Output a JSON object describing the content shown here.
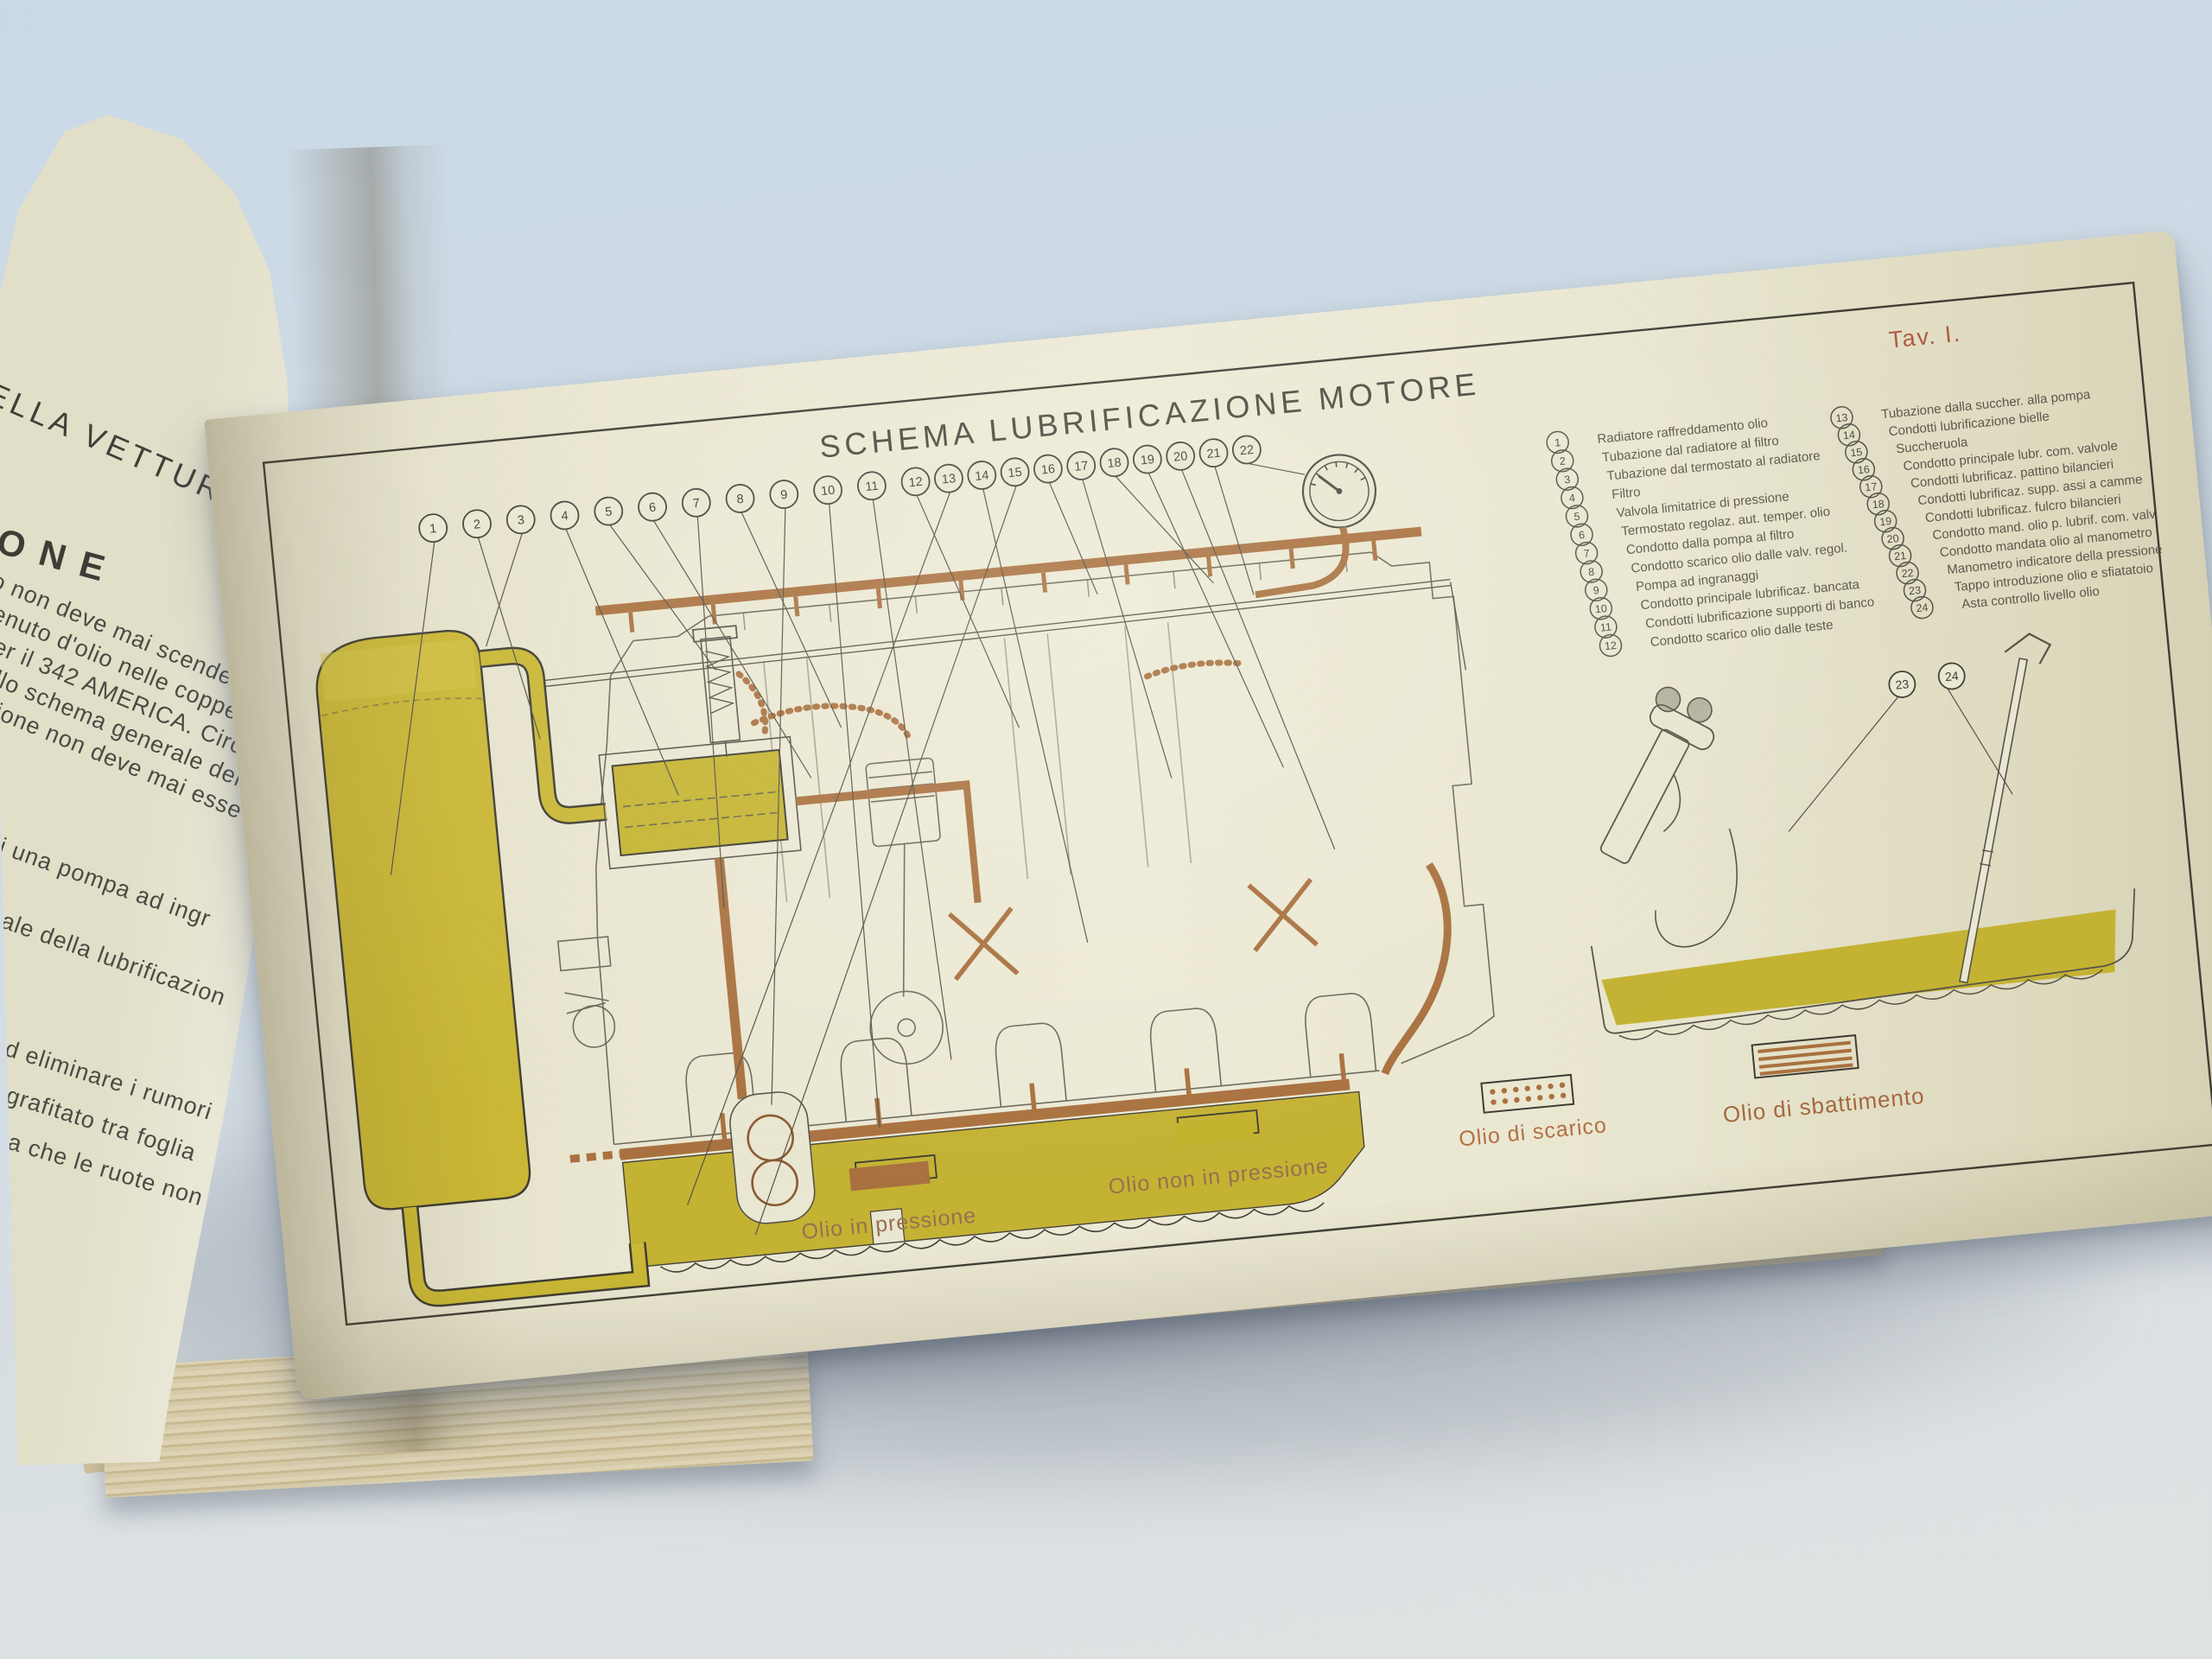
{
  "scene": {
    "description_background": "#cfdbe6",
    "page_color": "#e9e6d1"
  },
  "left_page": {
    "heading": "ELLA VETTURA",
    "subheading": "ONE",
    "body_lines": [
      "o non deve mai scende",
      "enuto d'olio nelle coppe",
      "er il 342 AMERICA. Circ",
      "llo schema generale del",
      "ione non deve mai esse",
      "i una pompa ad ingr",
      "ale della lubrificazion",
      "d eliminare i rumori",
      "grafitato tra foglia",
      "a che le ruote non"
    ]
  },
  "plate": {
    "title": "SCHEMA LUBRIFICAZIONE MOTORE",
    "plate_number": "Tav. I.",
    "legend": [
      {
        "num": "1",
        "label": "Radiatore raffreddamento olio"
      },
      {
        "num": "2",
        "label": "Tubazione dal radiatore al filtro"
      },
      {
        "num": "3",
        "label": "Tubazione dal termostato al radiatore"
      },
      {
        "num": "4",
        "label": "Filtro"
      },
      {
        "num": "5",
        "label": "Valvola limitatrice di pressione"
      },
      {
        "num": "6",
        "label": "Termostato regolaz. aut. temper. olio"
      },
      {
        "num": "7",
        "label": "Condotto dalla pompa al filtro"
      },
      {
        "num": "8",
        "label": "Condotto scarico olio dalle valv. regol."
      },
      {
        "num": "9",
        "label": "Pompa ad ingranaggi"
      },
      {
        "num": "10",
        "label": "Condotto principale lubrificaz. bancata"
      },
      {
        "num": "11",
        "label": "Condotti lubrificazione supporti di banco"
      },
      {
        "num": "12",
        "label": "Condotto scarico olio dalle teste"
      },
      {
        "num": "13",
        "label": "Tubazione dalla succher. alla pompa"
      },
      {
        "num": "14",
        "label": "Condotti lubrificazione bielle"
      },
      {
        "num": "15",
        "label": "Succheruola"
      },
      {
        "num": "16",
        "label": "Condotto principale lubr. com. valvole"
      },
      {
        "num": "17",
        "label": "Condotti lubrificaz. pattino bilancieri"
      },
      {
        "num": "18",
        "label": "Condotti lubrificaz. supp. assi a camme"
      },
      {
        "num": "19",
        "label": "Condotti lubrificaz. fulcro bilancieri"
      },
      {
        "num": "20",
        "label": "Condotto mand. olio p. lubrif. com. valv."
      },
      {
        "num": "21",
        "label": "Condotto mandata olio al manometro"
      },
      {
        "num": "22",
        "label": "Manometro indicatore della pressione"
      },
      {
        "num": "23",
        "label": "Tappo introduzione olio e sfiatatoio"
      },
      {
        "num": "24",
        "label": "Asta controllo livello olio"
      }
    ],
    "detail_callouts": [
      "23",
      "24"
    ],
    "swatches": [
      {
        "label": "Olio in pressione",
        "type": "solid-brown"
      },
      {
        "label": "Olio non in pressione",
        "type": "solid-yellow"
      },
      {
        "label": "Olio di scarico",
        "type": "dotted"
      },
      {
        "label": "Olio di sbattimento",
        "type": "striped"
      }
    ],
    "colors": {
      "oil_pressure_brown": "#a9713f",
      "oil_free_yellow": "#c3b22c",
      "plate_number_red": "#b05a44",
      "ink": "#55524a"
    }
  }
}
